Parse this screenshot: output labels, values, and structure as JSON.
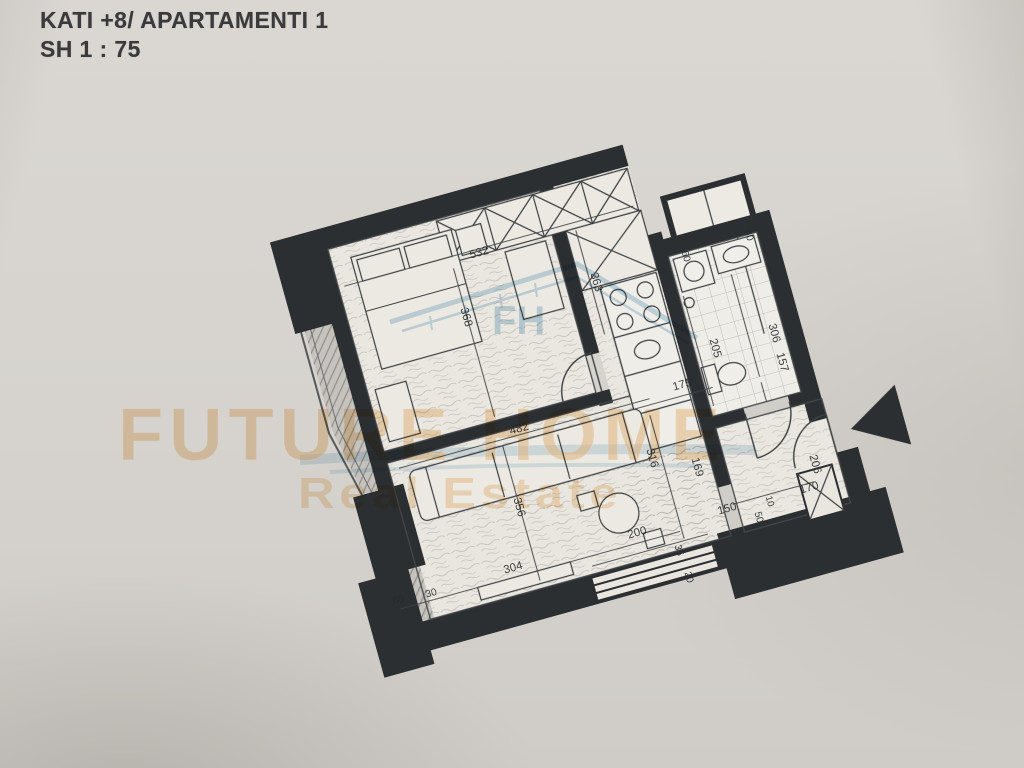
{
  "document": {
    "title": "KATI +8/ APARTAMENTI 1",
    "scale": "SH 1 : 75"
  },
  "watermark": {
    "brand": "FUTURE HOME",
    "tagline": "Real Estate",
    "monogram": "FH"
  },
  "plan": {
    "type": "apartment floor plan, rotated scan",
    "dimensions": [
      {
        "id": "bedroom-top-wall",
        "value": "532"
      },
      {
        "id": "closet-side",
        "value": "363"
      },
      {
        "id": "bedroom-width",
        "value": "368"
      },
      {
        "id": "shaft-top",
        "value": "60"
      },
      {
        "id": "shaft-left",
        "value": "60"
      },
      {
        "id": "bath-left-depth",
        "value": "205"
      },
      {
        "id": "bath-depth",
        "value": "306"
      },
      {
        "id": "bath-width",
        "value": "157"
      },
      {
        "id": "hall-opening",
        "value": "175"
      },
      {
        "id": "sofa-wall",
        "value": "482"
      },
      {
        "id": "living-right-depth",
        "value": "316"
      },
      {
        "id": "living-left-depth",
        "value": "356"
      },
      {
        "id": "hall-depth",
        "value": "169"
      },
      {
        "id": "entry-depth",
        "value": "206"
      },
      {
        "id": "entry-width",
        "value": "170"
      },
      {
        "id": "wall-gap",
        "value": "10"
      },
      {
        "id": "corridor-width",
        "value": "150"
      },
      {
        "id": "wall-fifty",
        "value": "50"
      },
      {
        "id": "bottom-window",
        "value": "200"
      },
      {
        "id": "wall-thirtyfive",
        "value": "35"
      },
      {
        "id": "wall-twenty",
        "value": "20"
      },
      {
        "id": "living-bottom",
        "value": "304"
      },
      {
        "id": "balcony-end",
        "value": "60"
      },
      {
        "id": "balcony-wall",
        "value": "30"
      }
    ]
  },
  "colors": {
    "paper": "#d8d5d0",
    "wall_ink": "#2c2f32",
    "line_ink": "#3f4244",
    "watermark_orange": "#f0c48a",
    "watermark_blue": "#9cc3db",
    "balcony_hatch": "#8f8c88"
  }
}
